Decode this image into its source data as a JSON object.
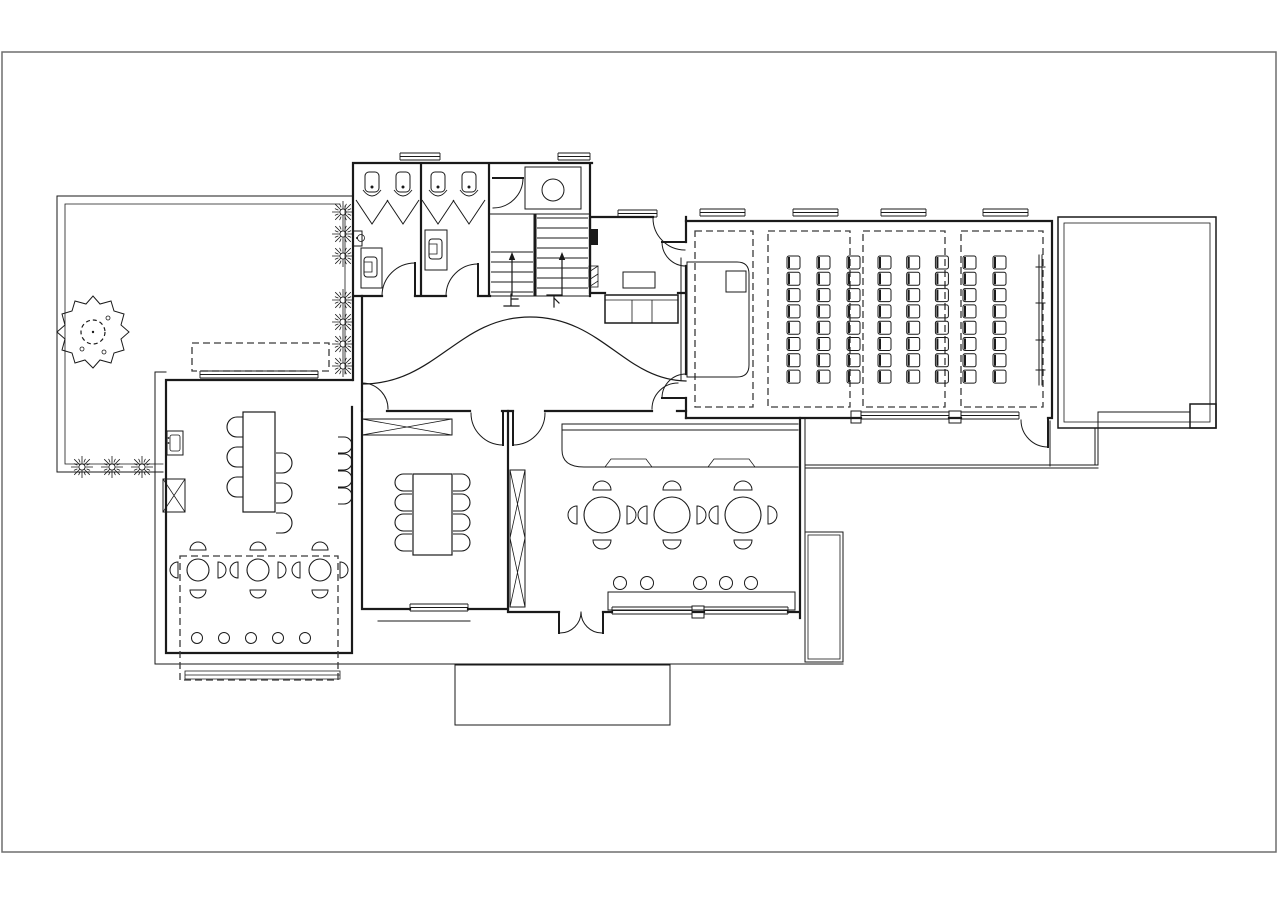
{
  "meta": {
    "drawing_type": "architectural-floor-plan",
    "colors": {
      "line": "#1a1a1a",
      "frame": "#6e6e6e",
      "background": "#ffffff",
      "dashed_zone": "#3a3a3a"
    }
  },
  "labels": {
    "stairs_up": "上",
    "stairs_down": "下"
  },
  "furniture": {
    "urinals": {
      "y": 172,
      "xs": [
        372,
        403,
        438,
        469
      ]
    },
    "urinal_screens": {
      "y_top": 200,
      "y_tip": 224,
      "half": 16,
      "xs": [
        372,
        403,
        438,
        469
      ]
    },
    "stairs": {
      "left_treads": {
        "x1": 491,
        "x2": 533,
        "ys": [
          252,
          262,
          272,
          282,
          292
        ]
      },
      "right_treads": {
        "x1": 537,
        "x2": 588,
        "ys": [
          218,
          228,
          238,
          248,
          258,
          268,
          278,
          288
        ]
      },
      "arrows": [
        {
          "x": 512,
          "y_tail": 296,
          "y_head": 252
        },
        {
          "x": 562,
          "y_tail": 296,
          "y_head": 252
        }
      ]
    },
    "auditorium_dashed_blocks": [
      [
        695,
        231,
        58,
        176
      ],
      [
        768,
        231,
        82,
        176
      ],
      [
        863,
        231,
        82,
        176
      ],
      [
        961,
        231,
        82,
        176
      ]
    ],
    "auditorium_chair_blocks": [
      {
        "x0": 787,
        "y0": 256,
        "cols": 3,
        "rows": 8,
        "dx": 30,
        "dy": 16.3,
        "w": 13,
        "h": 13
      },
      {
        "x0": 878,
        "y0": 256,
        "cols": 3,
        "rows": 8,
        "dx": 28.7,
        "dy": 16.3,
        "w": 13,
        "h": 13
      },
      {
        "x0": 963,
        "y0": 256,
        "cols": 2,
        "rows": 8,
        "dx": 30,
        "dy": 16.3,
        "w": 13,
        "h": 13
      }
    ],
    "round_tables": [
      {
        "cx": 198,
        "cy": 570,
        "r": 11,
        "chair_r": 8,
        "dist": 20
      },
      {
        "cx": 258,
        "cy": 570,
        "r": 11,
        "chair_r": 8,
        "dist": 20
      },
      {
        "cx": 320,
        "cy": 570,
        "r": 11,
        "chair_r": 8,
        "dist": 20
      },
      {
        "cx": 602,
        "cy": 515,
        "r": 18,
        "chair_r": 9,
        "dist": 25
      },
      {
        "cx": 672,
        "cy": 515,
        "r": 18,
        "chair_r": 9,
        "dist": 25
      },
      {
        "cx": 743,
        "cy": 515,
        "r": 18,
        "chair_r": 9,
        "dist": 25
      }
    ],
    "stool_rows": [
      {
        "y": 638,
        "r": 5.5,
        "xs": [
          197,
          224,
          251,
          278,
          305
        ]
      },
      {
        "y": 583,
        "r": 6.5,
        "xs": [
          620,
          647,
          700,
          726,
          751
        ]
      }
    ],
    "rect_table_chairs": [
      {
        "x": 227,
        "w": 16,
        "h": 20,
        "round": "left",
        "ys": [
          417,
          447,
          477
        ]
      },
      {
        "x": 276,
        "w": 16,
        "h": 20,
        "round": "right",
        "ys": [
          453,
          483,
          513
        ]
      },
      {
        "x": 338,
        "w": 14,
        "h": 16,
        "round": "right",
        "ys": [
          437,
          454,
          471,
          488
        ]
      },
      {
        "x": 395,
        "w": 17,
        "h": 17,
        "round": "left",
        "ys": [
          474,
          494,
          514,
          534
        ]
      },
      {
        "x": 453,
        "w": 17,
        "h": 17,
        "round": "right",
        "ys": [
          474,
          494,
          514,
          534
        ]
      }
    ],
    "shrubs": {
      "bottom_row": {
        "y": 467,
        "r": 11,
        "xs": [
          82,
          112,
          142
        ]
      },
      "right_column": {
        "x": 343,
        "r": 11,
        "ys": [
          212,
          234,
          256,
          300,
          322,
          344,
          366
        ]
      }
    },
    "windows": [
      {
        "x": 400,
        "y": 153,
        "w": 40
      },
      {
        "x": 558,
        "y": 153,
        "w": 32
      },
      {
        "x": 618,
        "y": 210,
        "w": 39
      },
      {
        "x": 700,
        "y": 209,
        "w": 45
      },
      {
        "x": 793,
        "y": 209,
        "w": 45
      },
      {
        "x": 881,
        "y": 209,
        "w": 45
      },
      {
        "x": 983,
        "y": 209,
        "w": 45
      },
      {
        "x": 861,
        "y": 412,
        "w": 88
      },
      {
        "x": 961,
        "y": 412,
        "w": 58
      },
      {
        "x": 410,
        "y": 604,
        "w": 58
      },
      {
        "x": 612,
        "y": 607,
        "w": 80
      },
      {
        "x": 704,
        "y": 607,
        "w": 84
      },
      {
        "x": 200,
        "y": 371,
        "w": 118
      }
    ],
    "tree": {
      "cx": 93,
      "cy": 332,
      "inner_r": 12
    }
  }
}
